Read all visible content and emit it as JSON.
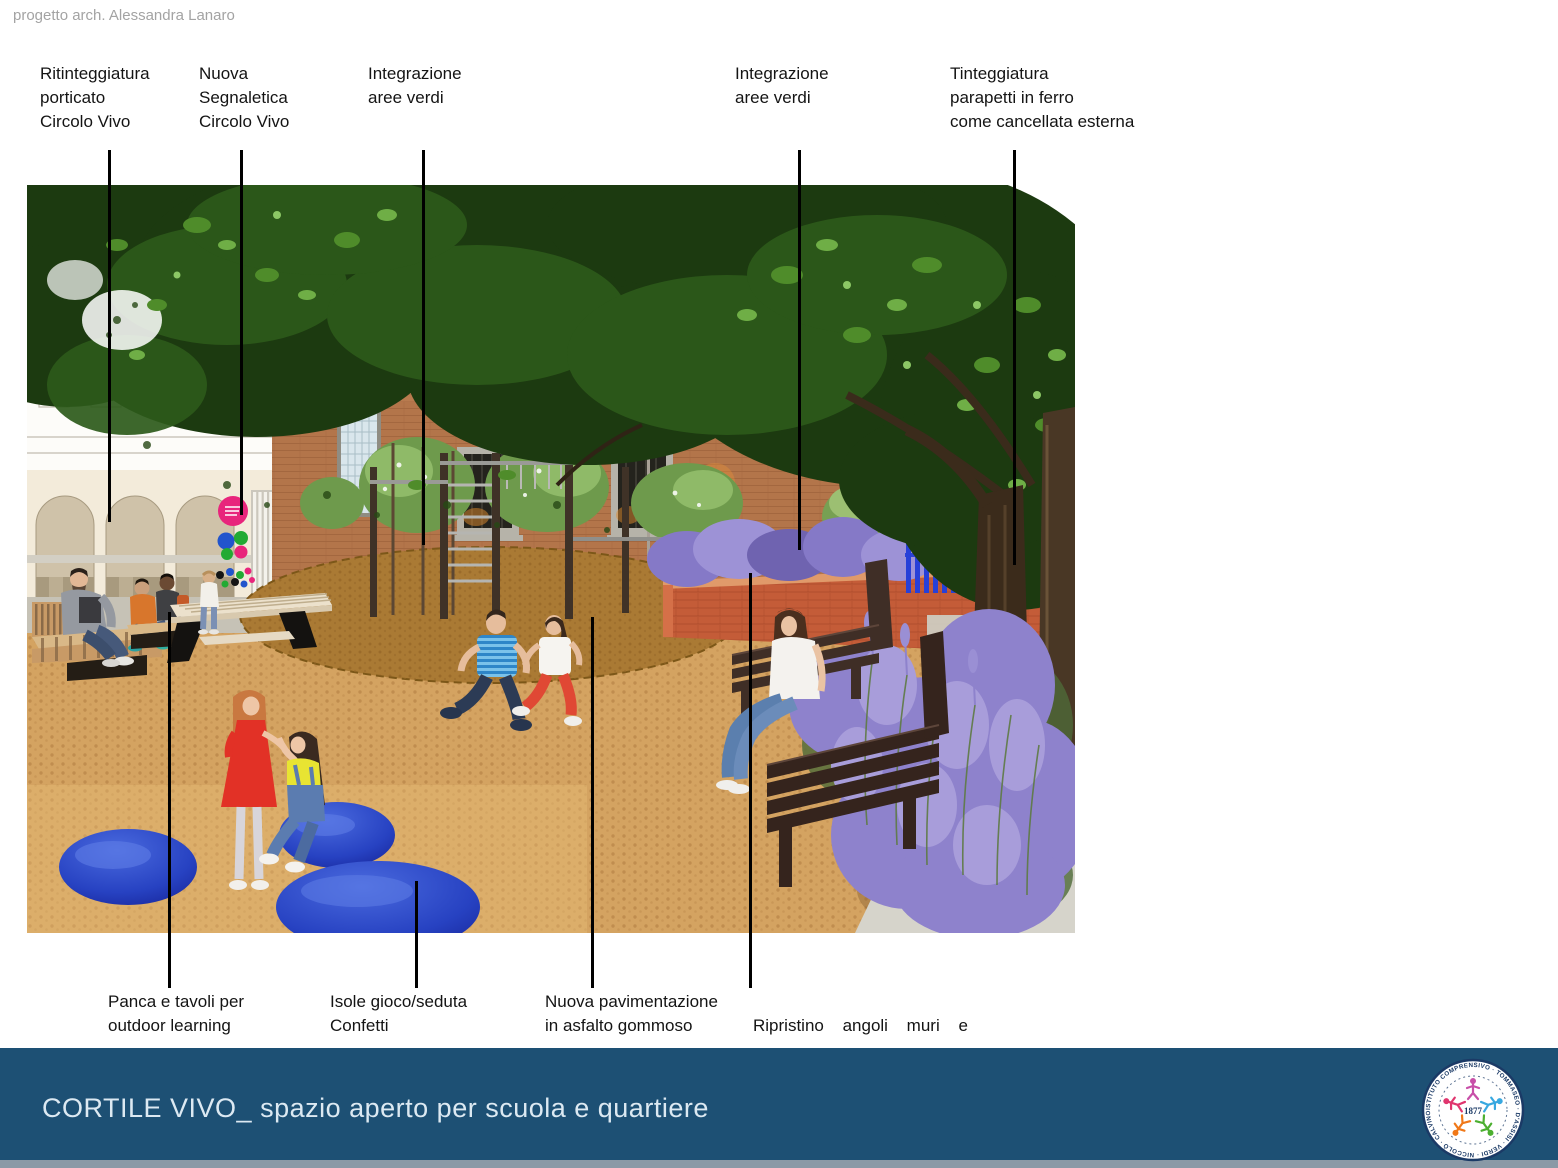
{
  "credit": "progetto arch. Alessandra Lanaro",
  "annotations": {
    "top": [
      {
        "text": "Ritinteggiatura\nporticato\nCircolo Vivo"
      },
      {
        "text": "Nuova\nSegnaletica\nCircolo Vivo"
      },
      {
        "text": "Integrazione\naree verdi"
      },
      {
        "text": "Integrazione\naree verdi"
      },
      {
        "text": "Tinteggiatura\nparapetti in ferro\ncome cancellata esterna"
      }
    ],
    "bottom": [
      {
        "text": "Panca e tavoli per\noutdoor learning"
      },
      {
        "text": "Isole gioco/seduta\nConfetti"
      },
      {
        "text": "Nuova pavimentazione\nin asfalto gommoso"
      },
      {
        "line1": "Ripristino angoli muri e",
        "line2": "pulizia davanzali in pietra"
      }
    ]
  },
  "footer": {
    "title_main": "CORTILE VIVO_",
    "title_sub": "spazio aperto per scuola e quartiere",
    "logo": {
      "year": "1877",
      "ring_text": "ISTITUTO COMPRENSIVO · TOMMASEO · D'ASSISI · VERDI · NICCOLÒ · CALVINO · PLANA · TOMMASEO ·"
    }
  },
  "colors": {
    "footer_bar": "#1d5074",
    "leader_line": "#000000",
    "label_text": "#141414",
    "credit_gray": "#a3a3a3",
    "title_text": "#dce9f2",
    "disc_blue": "#2742c2",
    "fence_blue": "#2740d8",
    "sign_pink": "#e8257c",
    "gravel": "#d4a361",
    "mulch": "#aa7a34",
    "brick": "#b3754a",
    "red_wall": "#c45c38",
    "lavender": "#8e82cc",
    "logo_navy": "#1b3a66"
  }
}
